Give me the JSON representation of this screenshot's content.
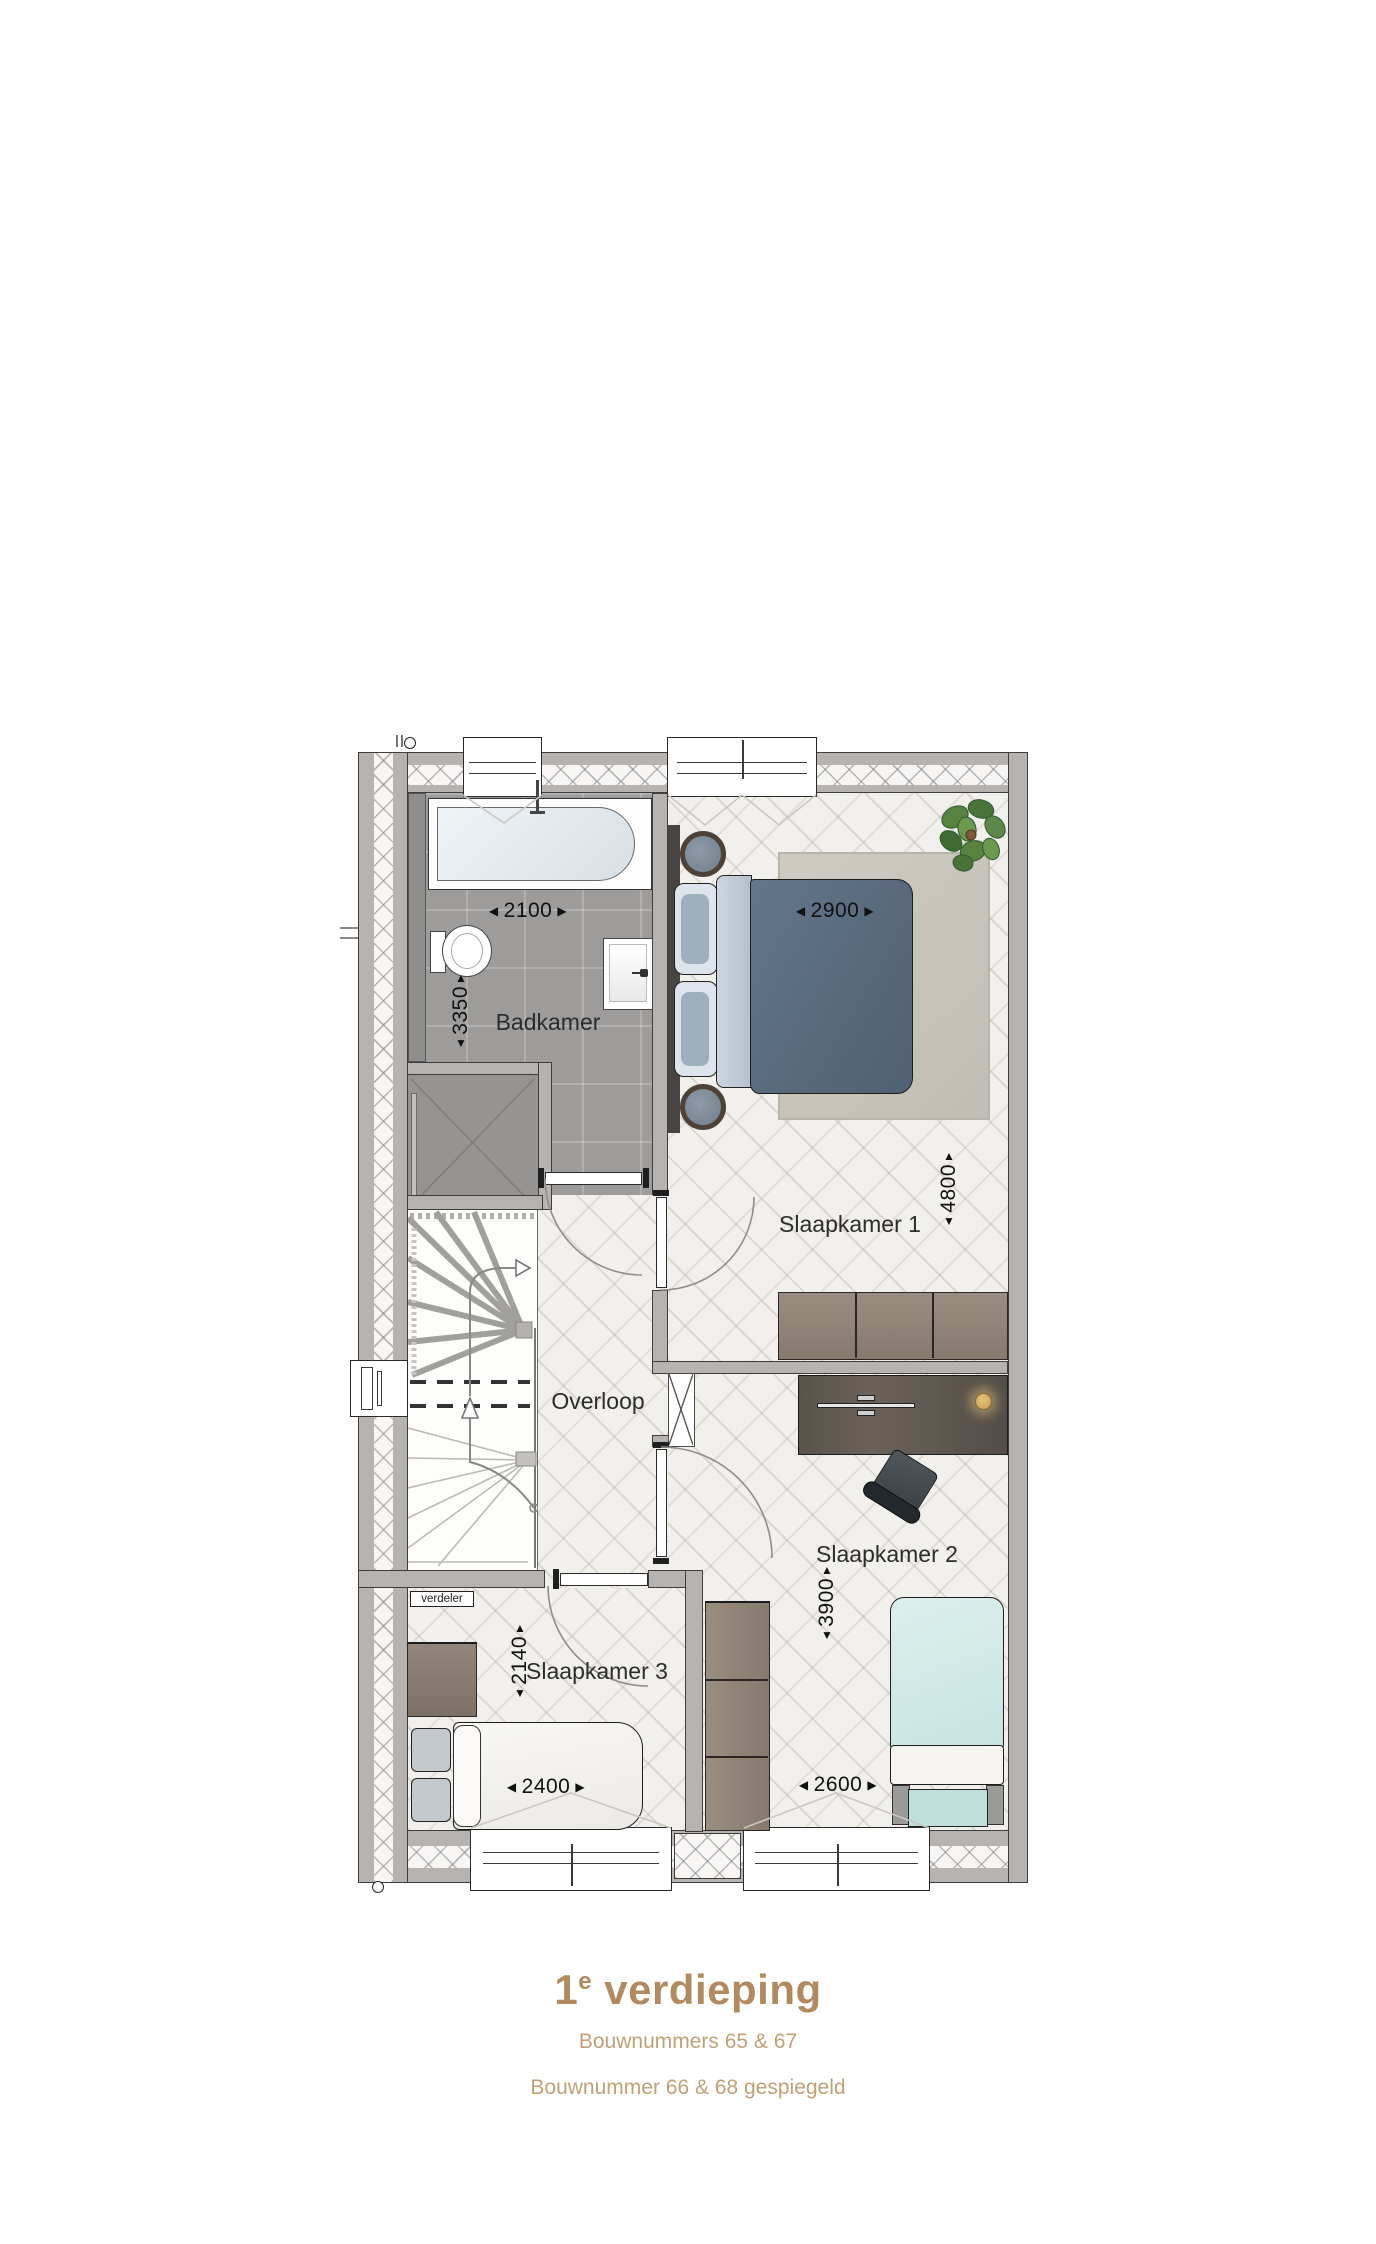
{
  "glyphs": {
    "left": "◀",
    "right": "▶",
    "up": "▲",
    "down": "▼"
  },
  "plan": {
    "rooms": {
      "badkamer": {
        "label": "Badkamer"
      },
      "slaapkamer1": {
        "label": "Slaapkamer 1"
      },
      "slaapkamer2": {
        "label": "Slaapkamer 2"
      },
      "slaapkamer3": {
        "label": "Slaapkamer 3"
      },
      "overloop": {
        "label": "Overloop"
      },
      "verdeler": {
        "label": "verdeler"
      }
    },
    "dims": {
      "badkamer_w": {
        "text": "2100"
      },
      "badkamer_h": {
        "text": "3350"
      },
      "slaapkamer1_w": {
        "text": "2900"
      },
      "slaapkamer1_h": {
        "text": "4800"
      },
      "slaapkamer2_h": {
        "text": "3900"
      },
      "slaapkamer2_w": {
        "text": "2600"
      },
      "slaapkamer3_h": {
        "text": "2140"
      },
      "slaapkamer3_w": {
        "text": "2400"
      }
    }
  },
  "caption": {
    "title_num": "1",
    "title_sup": "e",
    "title_rest": "verdieping",
    "line1": "Bouwnummers 65 & 67",
    "line2": "Bouwnummer 66 & 68 gespiegeld"
  },
  "colors": {
    "title": "#b28a5f",
    "subtitle": "#c2a076",
    "accent_lamp": "#d3aa5e"
  }
}
